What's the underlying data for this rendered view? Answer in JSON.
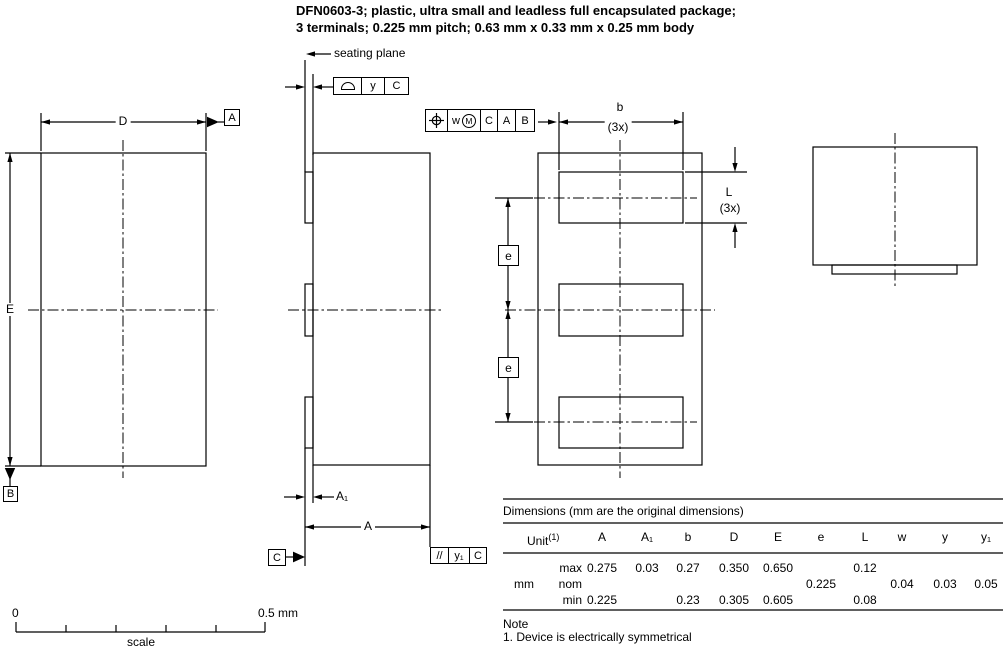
{
  "title": {
    "line1": "DFN0603-3; plastic, ultra small and leadless full encapsulated package;",
    "line2": "3 terminals; 0.225 mm pitch; 0.63 mm x 0.33 mm x 0.25 mm body"
  },
  "icons": {
    "profile_of_surface": "half-dome outline (profile of a surface GD&T symbol)",
    "true_position": "circle with crosshair (true position GD&T symbol)",
    "material_condition": "M in circle",
    "parallelism": "//"
  },
  "drawing": {
    "plan_view": {
      "dim_width": "D",
      "dim_length": "E",
      "datum_a": "A",
      "datum_b": "B"
    },
    "side_view": {
      "seating_plane_label": "seating plane",
      "dim_height": "A",
      "dim_standoff": "A₁",
      "datum_c": "C",
      "profile_frame": {
        "tolerance": "y",
        "datum": "C"
      },
      "parallelism_frame": {
        "symbol": "//",
        "tolerance": "y₁",
        "datum": "C"
      }
    },
    "bottom_view": {
      "dim_terminal_width": "b",
      "dim_terminal_width_count": "(3x)",
      "dim_terminal_length": "L",
      "dim_terminal_length_count": "(3x)",
      "dim_pitch_1": "e",
      "dim_pitch_2": "e",
      "position_frame": {
        "tolerance": "w",
        "modifier": "M",
        "datum1": "C",
        "datum2": "A",
        "datum3": "B"
      }
    }
  },
  "table": {
    "caption": "Dimensions (mm are the original dimensions)",
    "unit_label": "Unit",
    "unit_note_ref": "(1)",
    "unit_value": "mm",
    "columns": [
      "A",
      "A₁",
      "b",
      "D",
      "E",
      "e",
      "L",
      "w",
      "y",
      "y₁"
    ],
    "rows": [
      {
        "label": "max",
        "values": {
          "A": "0.275",
          "A1": "0.03",
          "b": "0.27",
          "D": "0.350",
          "E": "0.650",
          "L": "0.12"
        }
      },
      {
        "label": "nom",
        "values": {
          "e": "0.225",
          "w": "0.04",
          "y": "0.03",
          "y1": "0.05"
        }
      },
      {
        "label": "min",
        "values": {
          "A": "0.225",
          "b": "0.23",
          "D": "0.305",
          "E": "0.605",
          "L": "0.08"
        }
      }
    ]
  },
  "note": {
    "heading": "Note",
    "item1": "1. Device is electrically symmetrical"
  },
  "scale_bar": {
    "start_label": "0",
    "end_label": "0.5 mm",
    "caption": "scale"
  },
  "colors": {
    "line": "#000000",
    "background": "#ffffff"
  }
}
